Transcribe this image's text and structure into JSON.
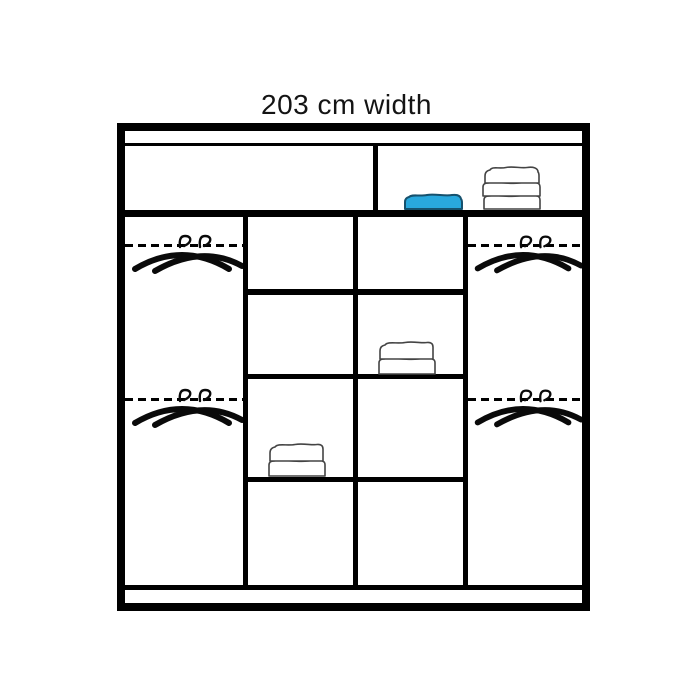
{
  "title": "203 cm width",
  "colors": {
    "outline": "#000000",
    "background": "#ffffff",
    "towel_stroke": "#444444",
    "blue_towel_fill": "#29a8dd",
    "blue_towel_stroke": "#16516d"
  },
  "wardrobe": {
    "top_section": {
      "left_compartment": {
        "contents": []
      },
      "right_compartment": {
        "contents": [
          "folded-towel-blue",
          "folded-towel-stack-3"
        ]
      }
    },
    "columns": [
      {
        "id": "left-hanging",
        "type": "hanging",
        "rails": [
          {
            "icon": "double-hanger-icon"
          },
          {
            "icon": "double-hanger-icon"
          }
        ]
      },
      {
        "id": "shelf-column-1",
        "type": "shelves",
        "shelf_count": 4,
        "contents": [
          {
            "shelf_index": 3,
            "item": "folded-towel-stack-2"
          }
        ]
      },
      {
        "id": "shelf-column-2",
        "type": "shelves",
        "shelf_count": 4,
        "contents": [
          {
            "shelf_index": 2,
            "item": "folded-towel-stack-2"
          }
        ]
      },
      {
        "id": "right-hanging",
        "type": "hanging",
        "rails": [
          {
            "icon": "double-hanger-icon"
          },
          {
            "icon": "double-hanger-icon"
          }
        ]
      }
    ]
  }
}
